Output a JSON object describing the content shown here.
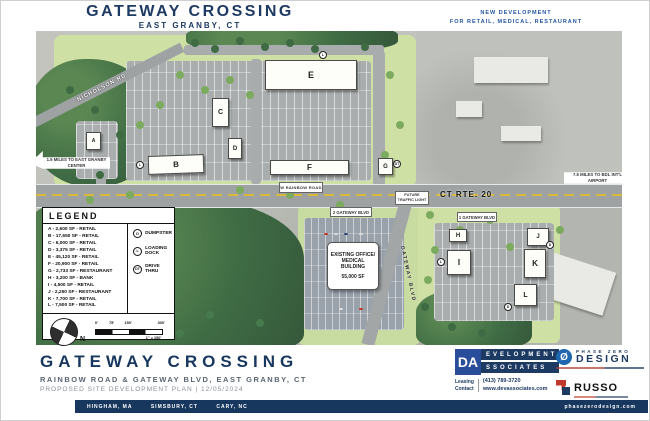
{
  "header": {
    "title": "GATEWAY CROSSING",
    "subtitle": "EAST GRANBY, CT",
    "tagline1": "NEW DEVELOPMENT",
    "tagline2": "FOR RETAIL, MEDICAL, RESTAURANT"
  },
  "plan": {
    "roads": {
      "nicholson": "NICHOLSON RD",
      "rainbow": "W RAINBOW ROAD",
      "route20": "CT RTE. 20",
      "gateway": "GATEWAY BLVD"
    },
    "callouts": {
      "east_granby": "1.5 MILES TO EAST GRANBY CENTER",
      "airport": "7.5 MILES TO BDL INT'L AIRPORT",
      "traffic_light1": "FUTURE",
      "traffic_light2": "TRAFFIC LIGHT",
      "address1": "1 GATEWAY BLVD",
      "address2": "2 GATEWAY BLVD"
    },
    "existing_building": {
      "name": "EXISTING OFFICE/ MEDICAL BUILDING",
      "size": "55,000 SF"
    },
    "buildings": [
      "A",
      "B",
      "C",
      "D",
      "E",
      "F",
      "G",
      "H",
      "I",
      "J",
      "K",
      "L"
    ],
    "markers": [
      "L",
      "L",
      "DT",
      "L",
      "D",
      "D"
    ]
  },
  "legend": {
    "title": "LEGEND",
    "items": [
      "A - 2,600 SF - RETAIL",
      "B - 17,650 SF - RETAIL",
      "C - 6,000 SF - RETAIL",
      "D - 3,375 SF - RETAIL",
      "E - 45,120 SF - RETAIL",
      "F - 20,900 SF - RETAIL",
      "G - 2,733 SF - RESTAURANT",
      "H - 3,200 SF - BANK",
      "I - 4,500 SF - RETAIL",
      "J - 2,250 SF - RESTAURANT",
      "K - 7,700 SF - RETAIL",
      "L - 7,500 SF - RETAIL"
    ],
    "symbols": [
      {
        "key": "D",
        "label": "DUMPSTER"
      },
      {
        "key": "L",
        "label": "LOADING DOCK"
      },
      {
        "key": "DT",
        "label": "DRIVE THRU"
      }
    ],
    "north": "N",
    "scale_ticks": [
      "0'",
      "75'",
      "150'",
      "300'"
    ],
    "scale_ratio": "1\" = 150'"
  },
  "footer": {
    "title": "GATEWAY CROSSING",
    "address": "RAINBOW ROAD & GATEWAY BLVD, EAST GRANBY, CT",
    "plan_line": "PROPOSED SITE DEVELOPMENT PLAN  |  12/05/2024"
  },
  "logos": {
    "dev_associates": {
      "initials": "DA",
      "word1": "EVELOPMENT",
      "word2": "SSOCIATES",
      "leasing1": "Leasing",
      "leasing2": "Contact",
      "phone": "(413) 789-3720",
      "website": "www.devassociates.com"
    },
    "phase_zero": {
      "symbol": "Ø",
      "word1": "PHASE ZERO",
      "word2": "DESIGN"
    },
    "russo": {
      "name": "RUSSO"
    }
  },
  "bottom_bar": {
    "city1": "HINGHAM, MA",
    "city2": "SIMSBURY, CT",
    "city3": "CARY, NC",
    "website": "phasezerodesign.com"
  }
}
